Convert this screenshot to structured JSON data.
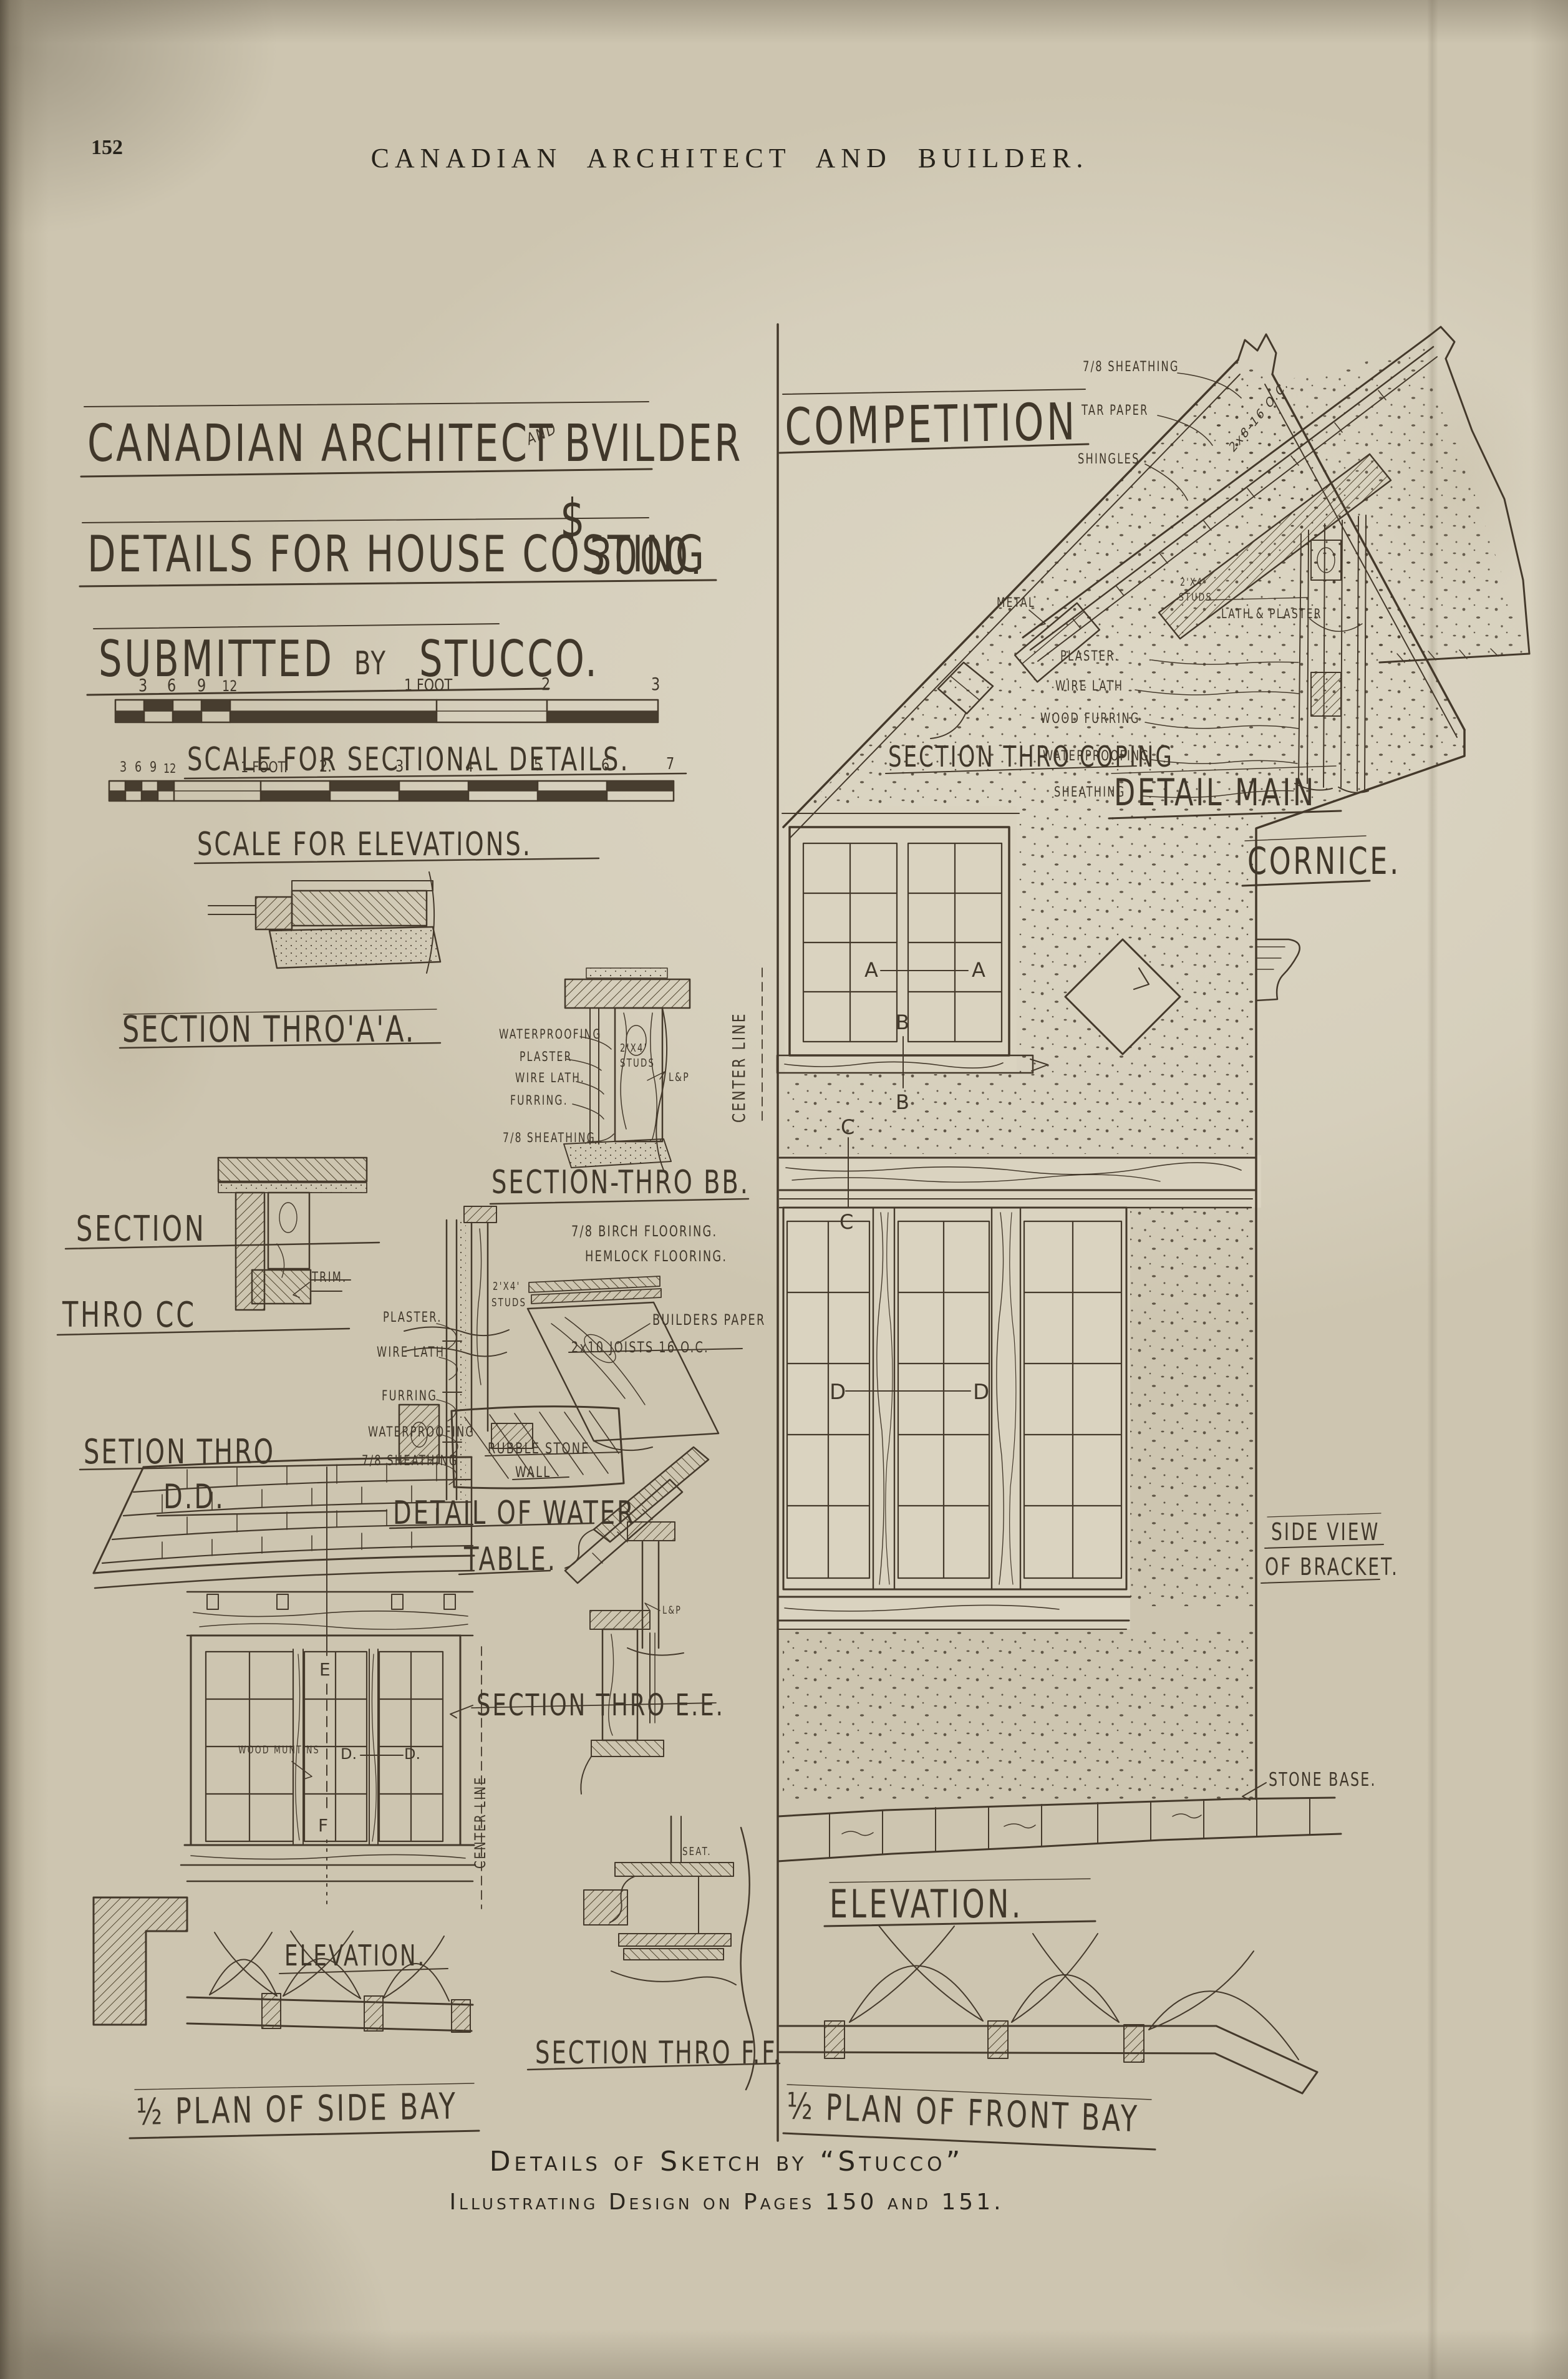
{
  "page": {
    "number": "152",
    "masthead": "CANADIAN ARCHITECT AND BUILDER."
  },
  "title": {
    "l1a": "CANADIAN ARCHITECT",
    "l1and": "AND",
    "l1b": "BVILDER",
    "l1c": "COMPETITION",
    "l2": "DETAILS FOR HOUSE COSTING",
    "dollar": "$",
    "cost": "3000.",
    "l3a": "SUBMITTED",
    "l3by": "BY",
    "l3b": "STUCCO."
  },
  "scales": {
    "sectional": {
      "label": "SCALE FOR SECTIONAL DETAILS.",
      "ticks": [
        "3",
        "6",
        "9",
        "12",
        "1 FOOT",
        "2",
        "3"
      ]
    },
    "elevations": {
      "label": "SCALE FOR ELEVATIONS.",
      "ticks": [
        "3",
        "6",
        "9",
        "12",
        "1 FOOT.",
        "2.",
        "3",
        "4",
        "5",
        "6",
        "7"
      ]
    }
  },
  "sections": {
    "aa": {
      "label": "SECTION THRO'A'A."
    },
    "bb": {
      "label": "SECTION-THRO BB.",
      "callouts": [
        "WATERPROOFING",
        "PLASTER",
        "WIRE LATH.",
        "FURRING.",
        "7/8 SHEATHING"
      ],
      "studs1": "2'X4'",
      "studs2": "STUDS",
      "lp": "L&P"
    },
    "cc": {
      "label1": "SECTION",
      "label2": "THRO CC",
      "trim": "TRIM."
    },
    "dd": {
      "label1": "SETION THRO",
      "label2": "D.D.",
      "callouts": [
        "PLASTER.",
        "WIRE LATH.",
        "FURRING",
        "WATERPROOFING",
        "7/8 SHEATHING"
      ]
    },
    "floor": {
      "callouts": [
        "7/8 BIRCH FLOORING.",
        "HEMLOCK FLOORING.",
        "BUILDERS PAPER",
        "2x10 JOISTS 16 O.C."
      ],
      "studs1": "2'X4'",
      "studs2": "STUDS"
    },
    "water": {
      "label1": "DETAIL OF WATER",
      "label2": "TABLE.",
      "wall1": "RUBBLE STONE",
      "wall2": "WALL",
      "lp": "L&P"
    },
    "ee": {
      "label": "SECTION THRO E.E."
    },
    "ff": {
      "label": "SECTION THRO F.F.",
      "seat": "SEAT."
    },
    "coping": {
      "label": "SECTION THRO COPING"
    },
    "cornice": {
      "label1": "DETAIL MAIN",
      "label2": "CORNICE.",
      "roof_callouts": [
        "7/8 SHEATHING",
        "TAR PAPER",
        "SHINGLES"
      ],
      "rafter": "2x8-16 O.C.",
      "metal": "METAL",
      "wall_callouts": [
        "PLASTER.",
        "WIRE LATH",
        "WOOD FURRING",
        "WATERPROOFING",
        "SHEATHING"
      ],
      "studs1": "2'X4'",
      "studs2": "STUDS",
      "lath": "LATH & PLASTER"
    },
    "bracket": {
      "label1": "SIDE VIEW",
      "label2": "OF BRACKET."
    },
    "base": {
      "label": "STONE BASE."
    }
  },
  "main_elevation": {
    "label": "ELEVATION.",
    "plan_label": "½ PLAN OF FRONT BAY",
    "center_line": "CENTER LINE"
  },
  "side_bay": {
    "label": "ELEVATION.",
    "plan_label": "½ PLAN OF SIDE BAY",
    "center_line": "CENTER LINE",
    "muntins": "WOOD MUNTINS"
  },
  "markers": {
    "a": "A",
    "b": "B",
    "c": "C",
    "d": "D",
    "d_dot": "D.",
    "e": "E",
    "f": "F"
  },
  "caption": {
    "line1": "Details of Sketch by “Stucco”",
    "line2": "Illustrating Design on Pages 150 and 151."
  }
}
